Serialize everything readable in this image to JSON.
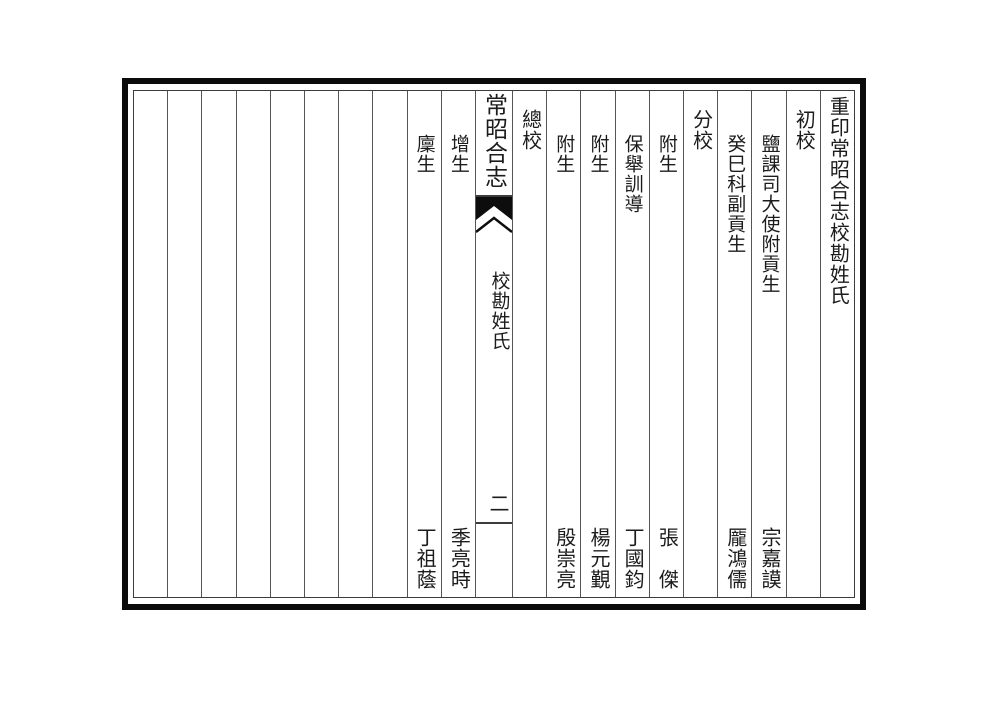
{
  "header": "重印常昭合志校勘姓氏",
  "folio": {
    "book_title": "常昭合志",
    "section": "校勘姓氏",
    "page_number": "二"
  },
  "roster": {
    "columns": [
      {
        "kind": "header",
        "text": "重印常昭合志校勘姓氏"
      },
      {
        "kind": "role",
        "text": "初校"
      },
      {
        "kind": "person",
        "title": "鹽課司大使附貢生",
        "name": "宗嘉謨"
      },
      {
        "kind": "person",
        "title": "癸巳科副貢生",
        "name": "龎鴻儒"
      },
      {
        "kind": "role",
        "text": "分校"
      },
      {
        "kind": "person",
        "title": "附生",
        "name": "張　傑"
      },
      {
        "kind": "person",
        "title": "保舉訓導",
        "name": "丁國鈞"
      },
      {
        "kind": "person",
        "title": "附生",
        "name": "楊元覲"
      },
      {
        "kind": "person",
        "title": "附生",
        "name": "殷崇亮"
      },
      {
        "kind": "role",
        "text": "總校"
      },
      {
        "kind": "person",
        "title": "增生",
        "name": "季亮時"
      },
      {
        "kind": "person",
        "title": "廩生",
        "name": "丁祖蔭"
      }
    ],
    "empty_column_count": 8
  },
  "colors": {
    "ink": "#1c1c1c",
    "rule_line": "#3c3c3c",
    "divider": "#565656",
    "border": "#0b0b0b",
    "paper": "#ffffff"
  }
}
